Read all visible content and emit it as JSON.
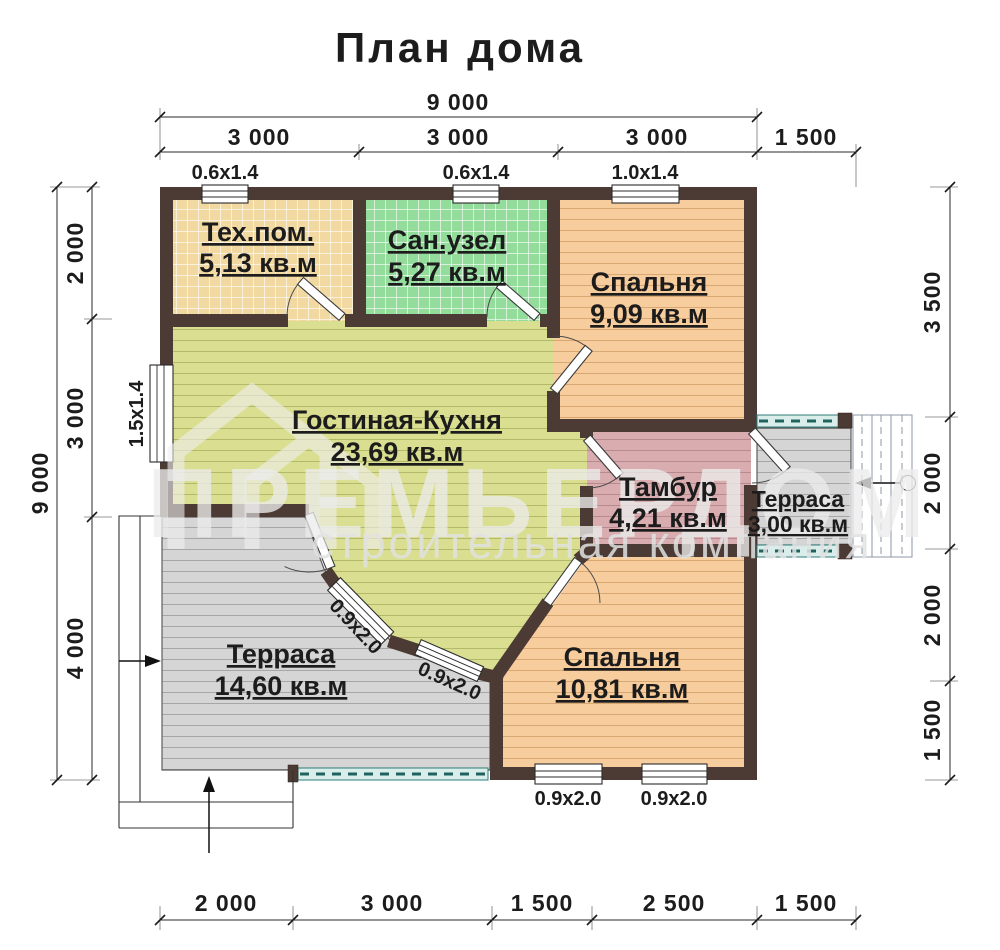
{
  "title": "План дома",
  "watermark": {
    "name": "ПРЕМЬЕРДОМ",
    "subtitle": "строительная компания"
  },
  "rooms": [
    {
      "id": "tech",
      "name": "Тех.пом.",
      "area": "5,13 кв.м"
    },
    {
      "id": "san",
      "name": "Сан.узел",
      "area": "5,27 кв.м"
    },
    {
      "id": "bedroom-top",
      "name": "Спальня",
      "area": "9,09 кв.м"
    },
    {
      "id": "living",
      "name": "Гостиная-Кухня",
      "area": "23,69 кв.м"
    },
    {
      "id": "tambour",
      "name": "Тамбур",
      "area": "4,21 кв.м"
    },
    {
      "id": "terrace-small",
      "name": "Терраса",
      "area": "3,00 кв.м"
    },
    {
      "id": "terrace-big",
      "name": "Терраса",
      "area": "14,60 кв.м"
    },
    {
      "id": "bedroom-bot",
      "name": "Спальня",
      "area": "10,81 кв.м"
    }
  ],
  "dimensions": {
    "top_total": "9 000",
    "top_segments": [
      "3 000",
      "3 000",
      "3 000",
      "1 500"
    ],
    "left_total": "9 000",
    "left_segments": [
      "2 000",
      "3 000",
      "4 000"
    ],
    "right_segments": [
      "3 500",
      "2 000",
      "2 000",
      "1 500"
    ],
    "bottom_segments": [
      "2 000",
      "3 000",
      "1 500",
      "2 500",
      "1 500"
    ]
  },
  "window_labels": [
    "0.6x1.4",
    "0.6x1.4",
    "1.0x1.4",
    "1.5x1.4",
    "0.9x2.0",
    "0.9x2.0",
    "0.9x2.0",
    "0.9x2.0"
  ],
  "colors": {
    "wall": "#4c3a34",
    "tech_room": "#f2d9a2",
    "san_room": "#93dc9c",
    "bedroom": "#f8cd9d",
    "living": "#dade90",
    "tambour": "#d9acb0",
    "terrace": "#d5d5d5",
    "railing": "#2e7d78"
  }
}
